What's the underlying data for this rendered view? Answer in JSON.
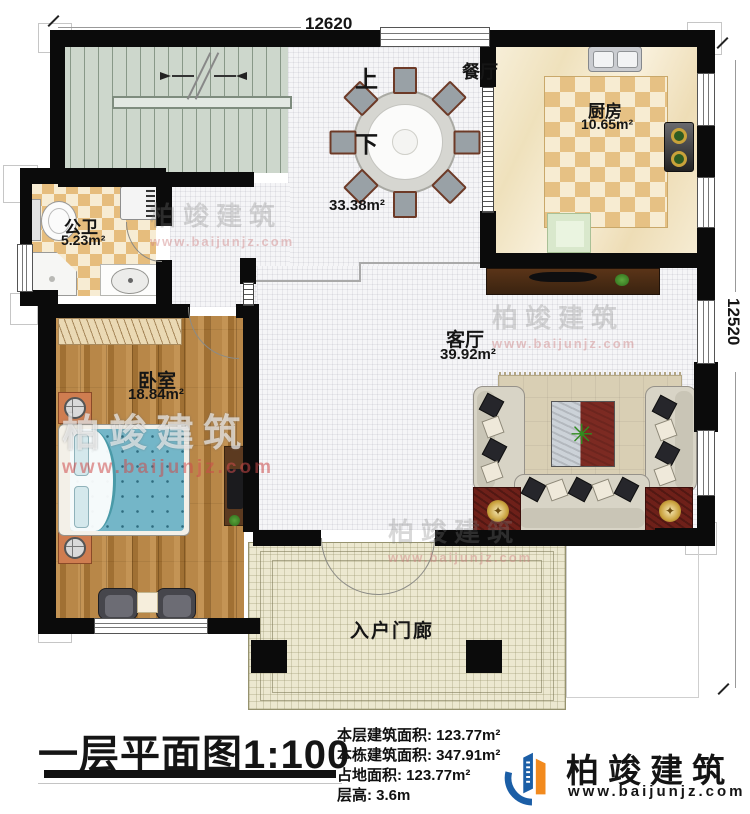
{
  "header": {
    "dim_top": "12620",
    "dim_right": "12520"
  },
  "rooms": {
    "dining": {
      "label": "餐厅",
      "area": "33.38m²"
    },
    "kitchen": {
      "label": "厨房",
      "area": "10.65m²"
    },
    "bathroom": {
      "label": "公卫",
      "area": "5.23m²"
    },
    "bedroom": {
      "label": "卧室",
      "area": "18.84m²"
    },
    "living": {
      "label": "客厅",
      "area": "39.92m²"
    },
    "porch": {
      "label": "入户门廊"
    },
    "stairs": {
      "up": "上",
      "down": "下"
    }
  },
  "titleblock": {
    "title": "一层平面图1:100",
    "info": [
      "本层建筑面积: 123.77m²",
      "本栋建筑面积: 347.91m²",
      "占地面积: 123.77m²",
      "层高: 3.6m"
    ]
  },
  "brand": {
    "name": "柏竣建筑",
    "url": "www.baijunjz.com"
  },
  "watermark": {
    "text": "柏竣建筑",
    "url": "www.baijunjz.com"
  },
  "icons": {
    "plant": "✳",
    "medallion": "✦"
  },
  "colors": {
    "wall": "#0b0b0b",
    "brand_blue": "#1b5ea6",
    "brand_orange": "#f28a1e",
    "wood": "#b07c3c",
    "bed": "#74b6c8",
    "checker": "#e6bd7d"
  }
}
